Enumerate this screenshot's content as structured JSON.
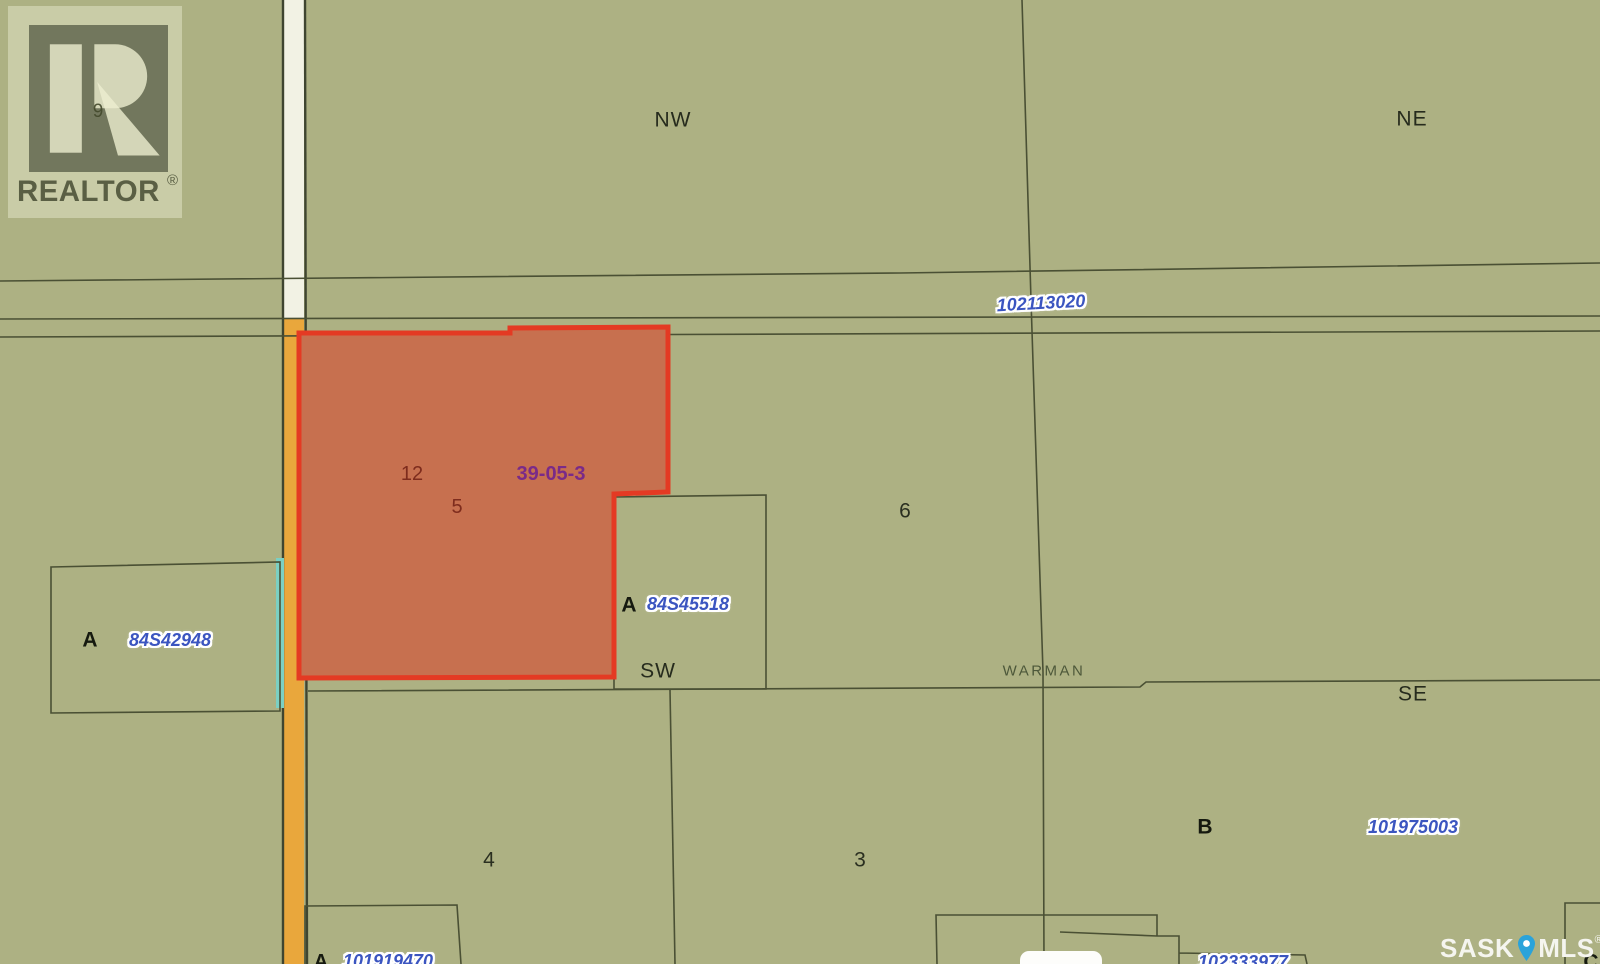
{
  "map": {
    "quarters": {
      "nw": "NW",
      "ne": "NE",
      "sw": "SW",
      "se": "SE"
    },
    "municipality": "WARMAN",
    "township": "39-05-3",
    "numbers": {
      "n12": "12",
      "n5": "5",
      "n6": "6",
      "n4": "4",
      "n3": "3",
      "n9": "9"
    },
    "parcels": {
      "road": {
        "id": "102113020"
      },
      "west": {
        "letter": "A",
        "id": "84S42948"
      },
      "center": {
        "letter": "A",
        "id": "84S45518"
      },
      "southeast": {
        "letter": "B",
        "id": "101975003"
      },
      "bottom_left": {
        "letter": "A",
        "id": "101919470"
      },
      "bottom_center": {
        "id": "102333977"
      },
      "bottom_right": {
        "letter": "C"
      }
    }
  },
  "watermark": {
    "text": "REALTOR",
    "registered": "®"
  },
  "brand": {
    "sask": "SASK",
    "mls": "MLS",
    "registered": "®"
  },
  "colors": {
    "background_green": "#adb183",
    "boundary_line": "#4a5034",
    "highlight_parcel_fill": "#c7704f",
    "highlight_parcel_border": "#e43a23",
    "road_orange": "#e9a73c",
    "road_white": "#f2f2e4",
    "teal_strip": "#7bd0c3",
    "parcel_id_blue": "#3b55c0",
    "township_purple": "#7a2a88",
    "highlight_number_maroon": "#7e2c1d",
    "pin_blue": "#2aa3da"
  }
}
